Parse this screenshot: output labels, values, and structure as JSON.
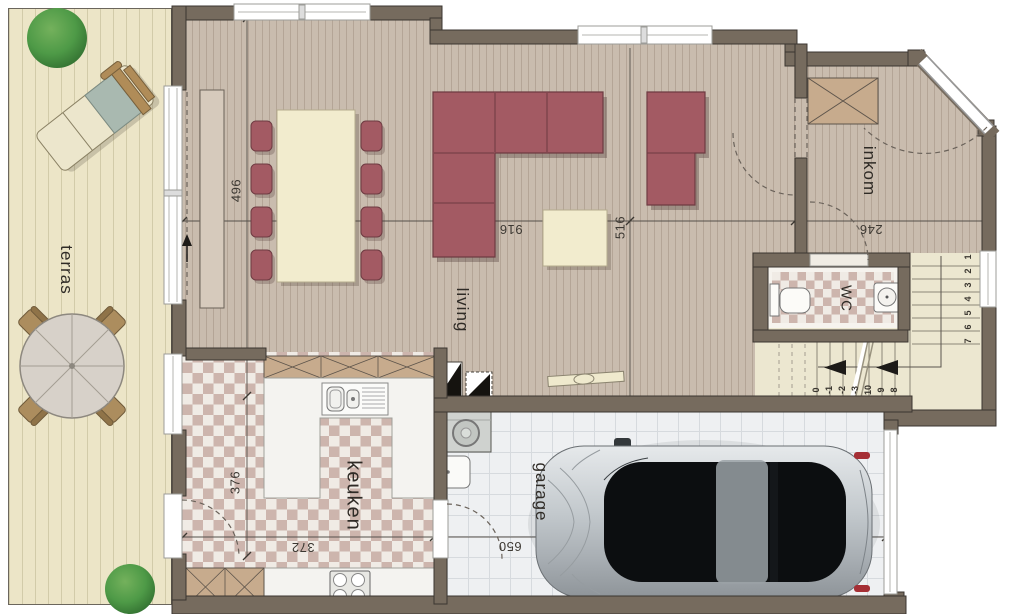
{
  "rooms": {
    "terras": "terras",
    "living": "living",
    "keuken": "keuken",
    "garage": "garage",
    "wc": "WC",
    "inkom": "inkom"
  },
  "dimensions": {
    "living_depth": "496",
    "living_width": "916",
    "living_right": "516",
    "inkom_width": "246",
    "keuken_depth": "376",
    "keuken_width": "372",
    "garage_width": "650"
  },
  "stairs": {
    "up": [
      "1",
      "2",
      "3",
      "4",
      "5",
      "6",
      "7"
    ],
    "down": [
      "0",
      "-1",
      "-2",
      "-3",
      "10",
      "9",
      "8"
    ]
  },
  "colors": {
    "wall": "#766b5e",
    "living_floor": "#c9bcae",
    "terrace_deck": "#ece5c7",
    "kitchen_tile_pink": "#cdb5ad",
    "garage_floor": "#eef0f2",
    "stairs_floor": "#ece7d0",
    "sofa": "#a35a63",
    "table": "#f2ecce",
    "cabinet": "#c7ab8d",
    "tree": "#4e9a47",
    "car": "#b9bfc4"
  }
}
